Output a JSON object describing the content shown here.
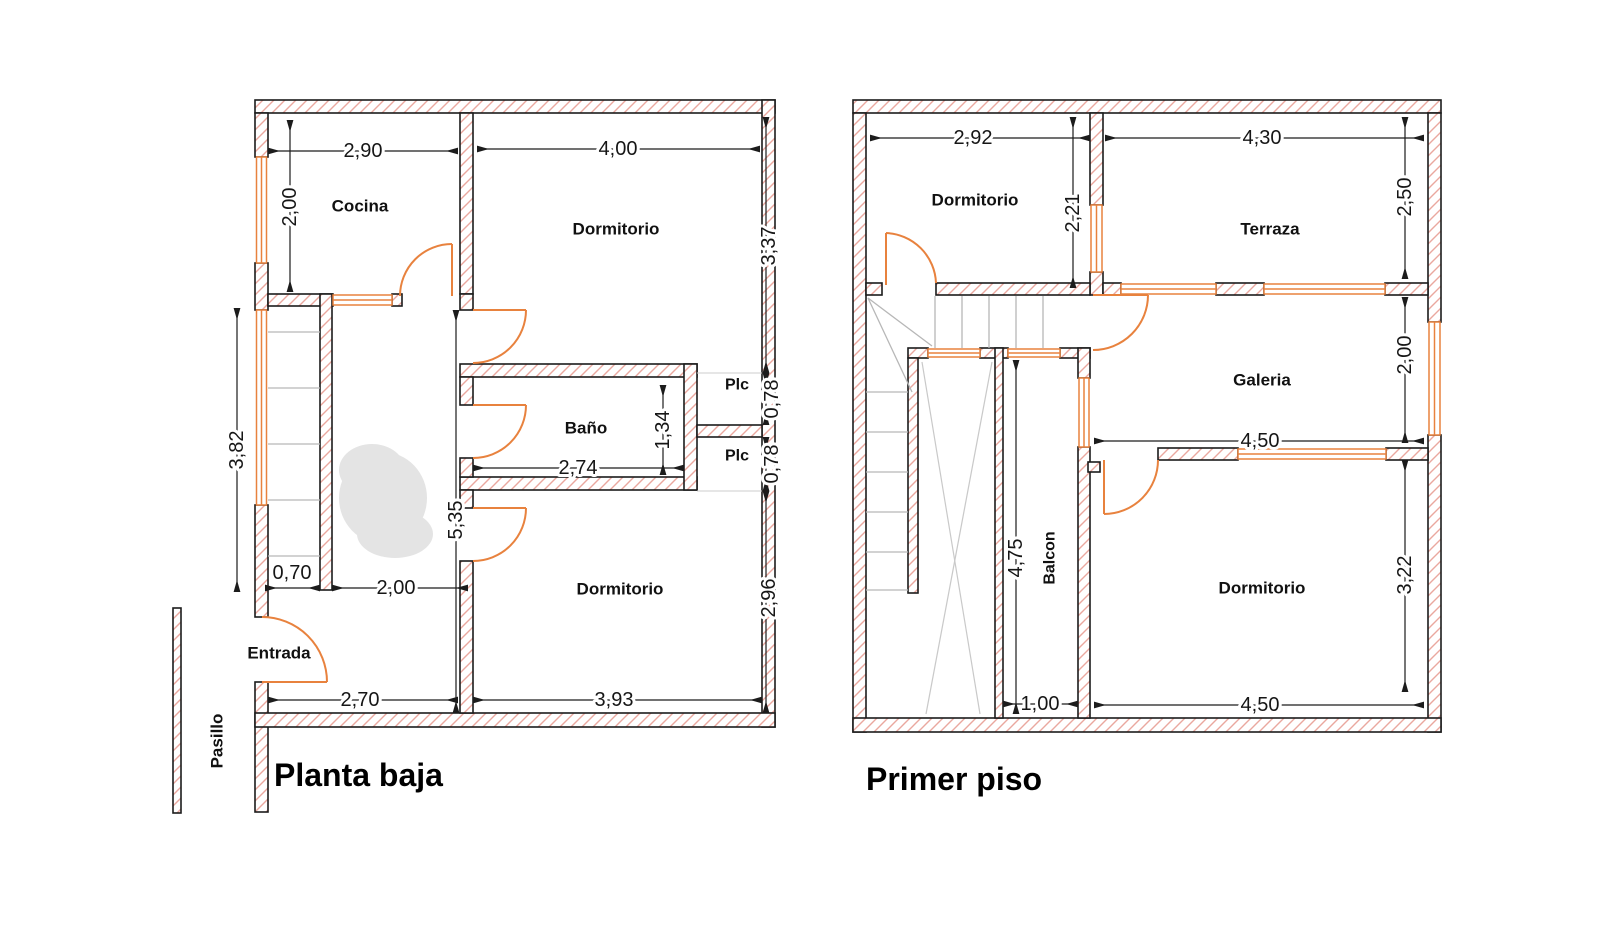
{
  "colors": {
    "wall_outline": "#1c1c1c",
    "wall_hatch": "#eaa89f",
    "opening_orange": "#e8823e",
    "stair_grey": "#b7b7b7",
    "void_grey": "#c9c9c9",
    "dim_text": "#161616",
    "smudge_grey": "#e4e4e4",
    "background": "#ffffff"
  },
  "planta_baja": {
    "title": "Planta baja",
    "rooms": {
      "cocina": "Cocina",
      "dormitorio_top": "Dormitorio",
      "bano": "Baño",
      "plc_top": "Plc",
      "plc_bottom": "Plc",
      "dormitorio_bottom": "Dormitorio",
      "entrada": "Entrada",
      "pasillo": "Pasillo"
    },
    "dims": {
      "cocina_w": "2,90",
      "cocina_h": "2,00",
      "dorm_top_w": "4,00",
      "dorm_top_h": "3,37",
      "stairs_h": "3,82",
      "stair_w": "0,70",
      "hall_w": "2,00",
      "hall_h": "5,35",
      "bano_w": "2,74",
      "bano_h": "1,34",
      "plc_top_h": "0,78",
      "plc_bottom_h": "0,78",
      "dorm_bottom_h": "2,96",
      "entrada_w": "2,70",
      "dorm_bottom_w": "3,93"
    }
  },
  "primer_piso": {
    "title": "Primer piso",
    "rooms": {
      "dormitorio_top": "Dormitorio",
      "terraza": "Terraza",
      "galeria": "Galeria",
      "balcon": "Balcon",
      "dormitorio_bottom": "Dormitorio"
    },
    "dims": {
      "dorm_top_w": "2,92",
      "dorm_top_h": "2,21",
      "terraza_w": "4,30",
      "terraza_h": "2,50",
      "galeria_h": "2,00",
      "galeria_w": "4,50",
      "balcon_h": "4,75",
      "balcon_w": "1,00",
      "dorm_bottom_h": "3,22",
      "dorm_bottom_w": "4,50"
    }
  }
}
